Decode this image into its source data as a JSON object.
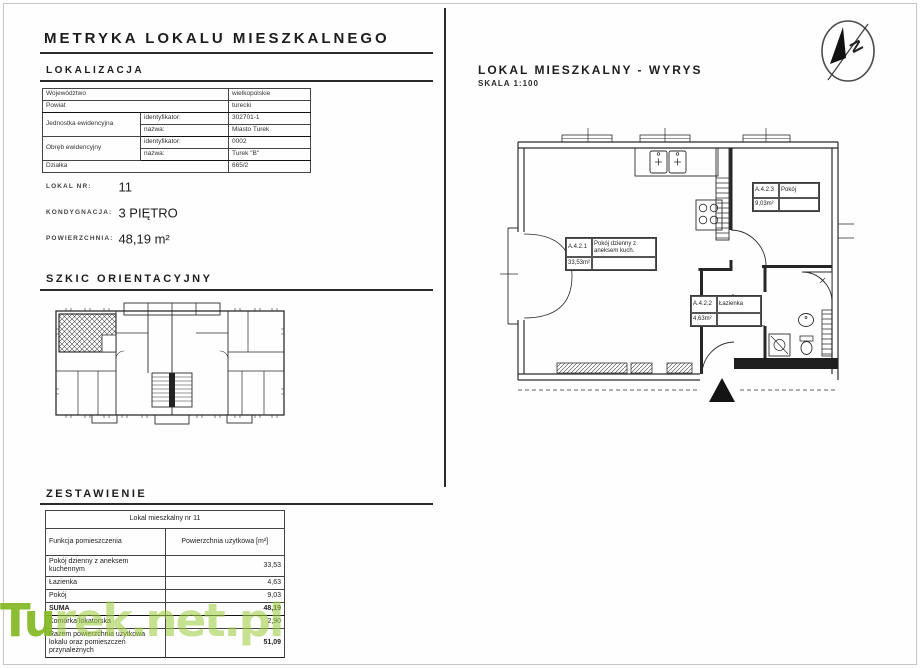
{
  "header": {
    "title": "METRYKA LOKALU MIESZKALNEGO"
  },
  "lokalizacja": {
    "heading": "LOKALIZACJA",
    "wojewodztwo_label": "Województwo",
    "wojewodztwo": "wielkopolskie",
    "powiat_label": "Powiat",
    "powiat": "turecki",
    "jednostka_label": "Jednostka ewidencyjna",
    "identyfikator_label": "identyfikator:",
    "nazwa_label": "nazwa:",
    "jednostka_id": "302701-1",
    "jednostka_nazwa": "Miasto Turek",
    "obreb_label": "Obręb ewidencyjny",
    "obreb_id": "0002",
    "obreb_nazwa": "Turek \"B\"",
    "dzialka_label": "Działka",
    "dzialka": "665/2"
  },
  "lokal": {
    "nr_label": "LOKAL NR:",
    "nr": "11",
    "kondygnacja_label": "KONDYGNACJA:",
    "kondygnacja": "3 PIĘTRO",
    "powierzchnia_label": "POWIERZCHNIA:",
    "powierzchnia": "48,19 m²"
  },
  "szkic": {
    "heading": "SZKIC ORIENTACYJNY"
  },
  "zestawienie": {
    "heading": "ZESTAWIENIE",
    "table_title": "Lokal mieszkalny nr 11",
    "col_funkcja": "Funkcja pomieszczenia",
    "col_powierzchnia": "Powierzchnia użytkowa [m²]",
    "rows": [
      {
        "label": "Pokój dzienny z aneksem kuchennym",
        "value": "33,53"
      },
      {
        "label": "Łazienka",
        "value": "4,63"
      },
      {
        "label": "Pokój",
        "value": "9,03"
      },
      {
        "label": "SUMA",
        "value": "48,19"
      },
      {
        "label": "Komórka lokatorska",
        "value": "2,90"
      },
      {
        "label": "Razem powierzchnia użytkowa lokalu oraz pomieszczeń przynależnych",
        "value": "51,09"
      }
    ]
  },
  "wyrys": {
    "heading": "LOKAL MIESZKALNY - WYRYS",
    "scale": "SKALA 1:100",
    "north_letter": "N",
    "rooms": {
      "living": {
        "id": "A.4.2.1",
        "name": "Pokój dzienny z aneksem kuch.",
        "area": "33,53m²"
      },
      "bathroom": {
        "id": "A.4.2.2",
        "name": "Łazienka",
        "area": "4,63m²"
      },
      "bedroom": {
        "id": "A.4.2.3",
        "name": "Pokój",
        "area": "9,03m²"
      }
    }
  },
  "watermark": {
    "bold_part": "Tu",
    "rest_part": "rek.net.pl",
    "color": "#9bc53d"
  }
}
